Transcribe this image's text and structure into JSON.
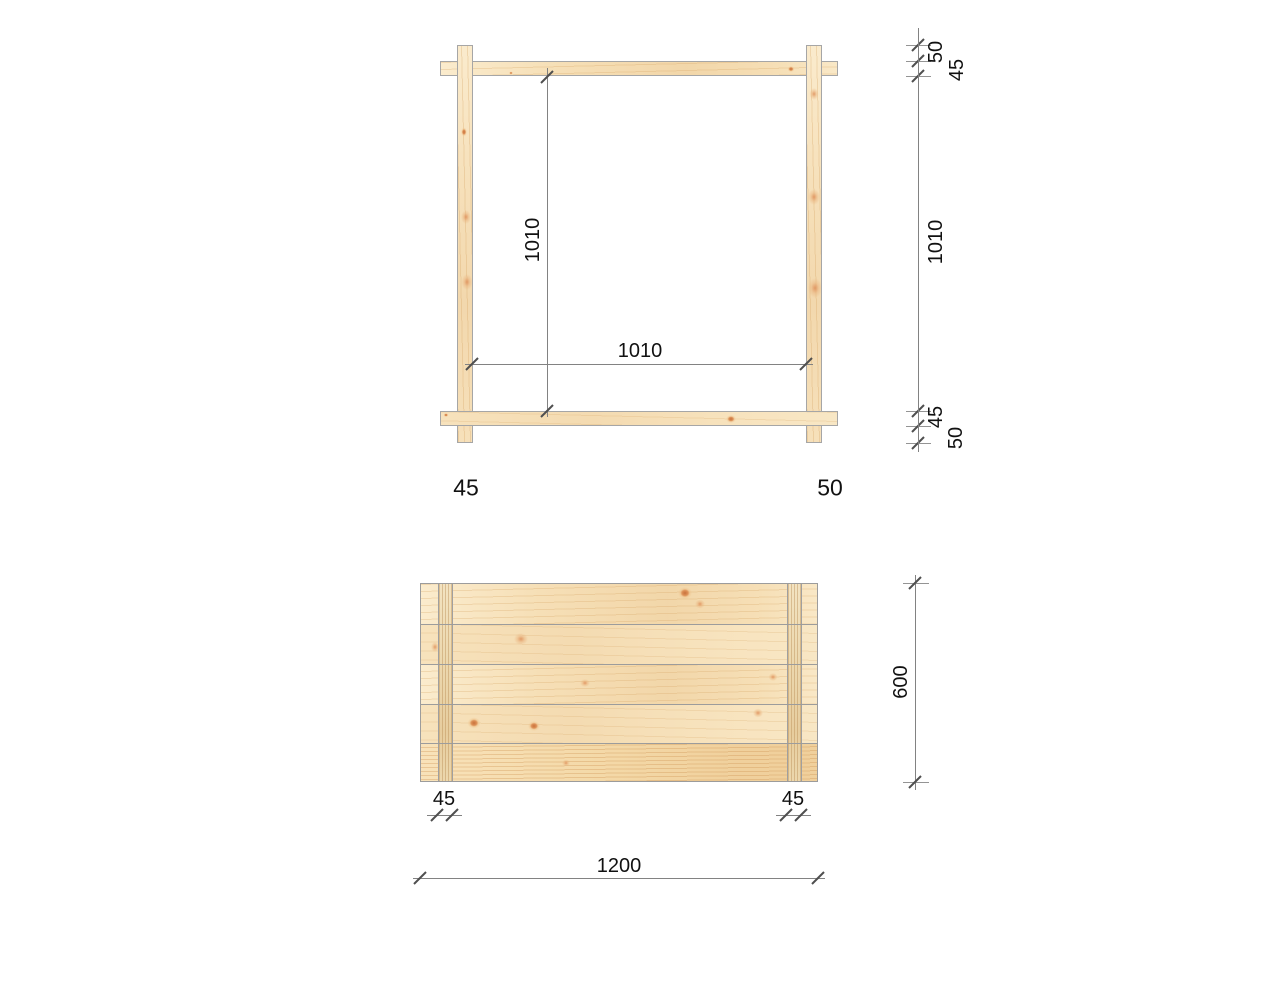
{
  "frame_view": {
    "dim_inner_height": "1010",
    "dim_inner_width": "1010",
    "chain": {
      "overhang_top": "50",
      "rail_thickness_top": "45",
      "inner": "1010",
      "rail_thickness_bottom": "45",
      "overhang_bottom": "50"
    },
    "post_width_label": "45",
    "overhang_label": "50"
  },
  "panel_view": {
    "batten_left_width": "45",
    "batten_right_width": "45",
    "overall_width": "1200",
    "overall_height": "600"
  },
  "colors": {
    "wood_base": "#f6dfb6",
    "wood_streak": "#d5a362",
    "wood_knot": "#c9723c",
    "piece_outline": "#a6a6a6",
    "dimension_line": "#828282",
    "tick_mark": "#4f4f4f",
    "text": "#111111",
    "background": "#ffffff"
  }
}
